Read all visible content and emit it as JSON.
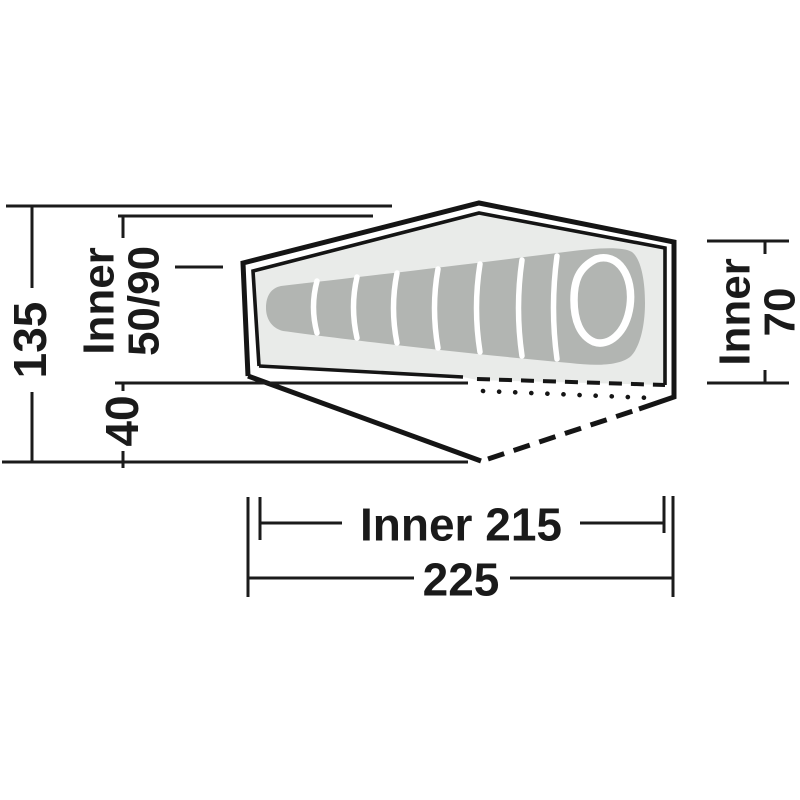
{
  "diagram": {
    "name": "tent-top-view-dimension-diagram",
    "description": "Top view floor plan of a one-person tent with sleeping bag, porch and dimension lines (cm)",
    "dimensions": {
      "total_width": "135",
      "inner_width_label": "Inner",
      "inner_width_value": "50/90",
      "porch_depth": "40",
      "inner_height_label": "Inner",
      "inner_height_value": "70",
      "inner_length": "Inner 215",
      "total_length": "225"
    },
    "colors": {
      "line": "#1b1b1b",
      "text": "#1a1a1a",
      "inner_tent_fill": "#e9ebe9",
      "sleeping_bag_fill": "#b2b5b2",
      "background": "#ffffff"
    }
  }
}
